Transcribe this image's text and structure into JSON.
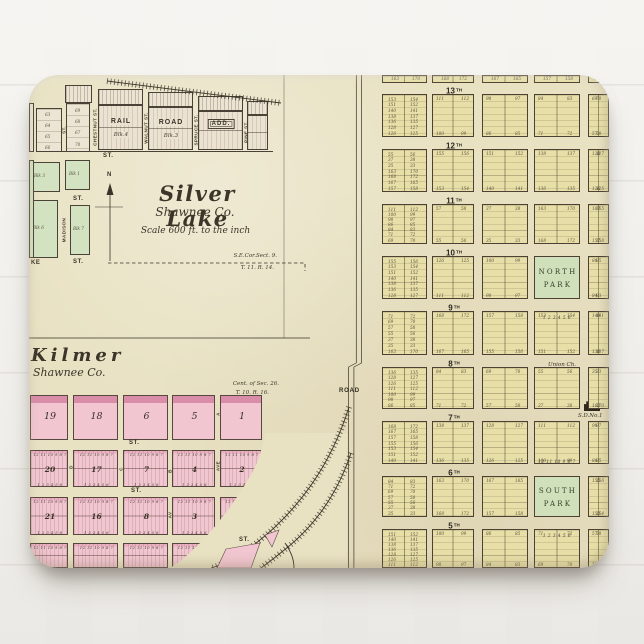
{
  "scene": {
    "product": "mousepad photographed on white painted wood"
  },
  "colors": {
    "paper": "#e8e1c2",
    "town_block": "#e7dfa7",
    "park_green": "#cfe0ba",
    "pink_block": "#f2c6d1",
    "pink_band": "#d98da8",
    "line_ink": "#4c4132",
    "wood": "#f1efec"
  },
  "silver_lake": {
    "title": "Silver Lake",
    "county": "Shawnee Co.",
    "scale_note": "Scale 600 ft. to the inch",
    "north_label": "N",
    "corner_note_line1": "S.E.Cor.Sect. 9.",
    "corner_note_line2": "T. 11. R. 14.",
    "addition": {
      "word1": "RAIL",
      "word2": "ROAD",
      "word3": "ADD."
    },
    "streets": {
      "chestnut": "CHESTNUT ST.",
      "walnut": "WALNUT ST.",
      "spruce": "SPRUCE ST.",
      "pine": "PINE ST.",
      "madison": "MADISON",
      "st": "ST."
    },
    "blocks": {
      "blk1": "Blk 1",
      "blk3": "Blk 3",
      "blk4": "Blk.4",
      "blk3b": "Blk.3",
      "blk6": "Blk 6",
      "blk7": "Blk 7"
    },
    "lots_col1": [
      "63",
      "64",
      "65",
      "66"
    ],
    "lots_col2": [
      "69",
      "68",
      "67",
      "70"
    ],
    "lake_partial": "KE"
  },
  "kilmer": {
    "title": "Kilmer",
    "county": "Shawnee Co.",
    "corner_note_line1": "Cent. of Sec. 26.",
    "corner_note_line2": "T. 10. R. 16.",
    "street_label": "ST.",
    "row1_blocks": [
      "19",
      "18",
      "6",
      "5",
      "1"
    ],
    "row2_blocks": [
      "20",
      "17",
      "7",
      "4",
      "2"
    ],
    "row3_blocks": [
      "21",
      "16",
      "8",
      "3"
    ],
    "lot_sequence_top": "12 11 10 9 8 7",
    "lot_sequence_bottom": "1 2 3 4 5 6",
    "avenue_letters": [
      "D",
      "C",
      "B",
      "AVE",
      "A",
      "AV"
    ]
  },
  "town_grid": {
    "streets": [
      {
        "num": "13",
        "suffix": "TH"
      },
      {
        "num": "12",
        "suffix": "TH"
      },
      {
        "num": "11",
        "suffix": "TH"
      },
      {
        "num": "10",
        "suffix": "TH"
      },
      {
        "num": "9",
        "suffix": "TH"
      },
      {
        "num": "8",
        "suffix": "TH"
      },
      {
        "num": "7",
        "suffix": "TH"
      },
      {
        "num": "6",
        "suffix": "TH"
      },
      {
        "num": "5",
        "suffix": "TH"
      }
    ],
    "north_park_line1": "NORTH",
    "north_park_line2": "PARK",
    "south_park_line1": "SOUTH",
    "south_park_line2": "PARK",
    "union_church": "Union Ch.",
    "school": "S.D.No.1",
    "road_label": "ROAD",
    "street_label": "ST.",
    "lots_below_north_park": "1 2 3 4 5 6",
    "lots_above_south_park": "12 11 10 9 8 7",
    "lots_below_south_park": "1 2 3 4 5 6",
    "sample_lot_numbers": [
      "163",
      "170",
      "168",
      "172",
      "167",
      "165",
      "157",
      "158",
      "155",
      "156",
      "153",
      "154",
      "151",
      "152",
      "140",
      "141",
      "138",
      "137",
      "136",
      "135",
      "128",
      "127",
      "126",
      "125",
      "111",
      "112",
      "100",
      "99",
      "98",
      "97",
      "86",
      "85",
      "84",
      "83",
      "71",
      "72",
      "69",
      "70",
      "57",
      "58",
      "55",
      "56",
      "37",
      "38",
      "35",
      "33"
    ]
  }
}
